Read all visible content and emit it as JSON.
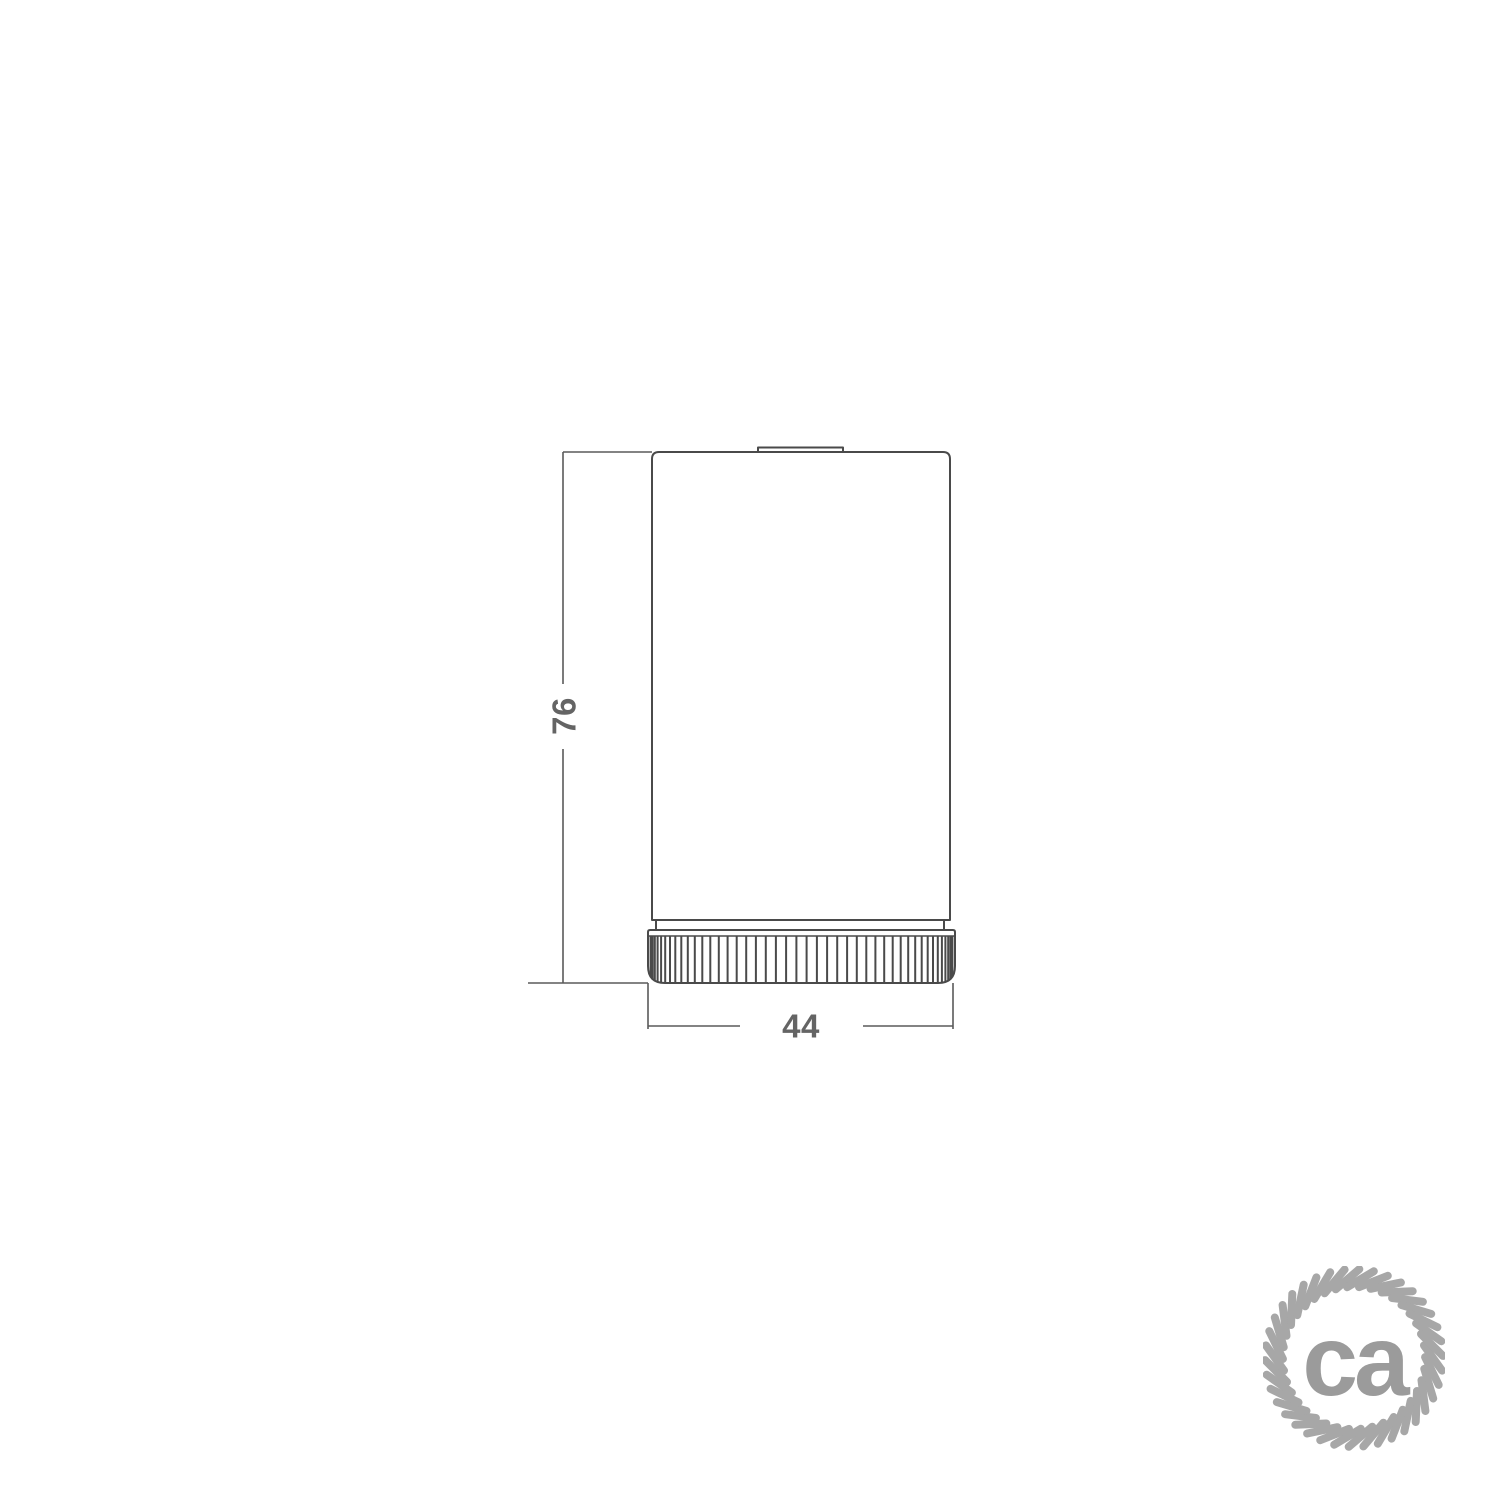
{
  "page": {
    "background_color": "#ffffff",
    "kind": "product dimension drawing"
  },
  "drawing": {
    "subject": "cylindrical lamp holder, side elevation",
    "line_color": "#4a4a4a",
    "dim_line_color": "#5a5a5a",
    "text_color": "#646464",
    "knurl_ridges": 46,
    "dimensions": {
      "height": {
        "value": "76",
        "orientation": "vertical"
      },
      "width": {
        "value": "44",
        "orientation": "horizontal"
      }
    }
  },
  "logo": {
    "text": "ca",
    "color": "#9b9b9b",
    "rope_color": "#a7a7a7",
    "rope_strands": 38,
    "shape": "rope-circle"
  }
}
